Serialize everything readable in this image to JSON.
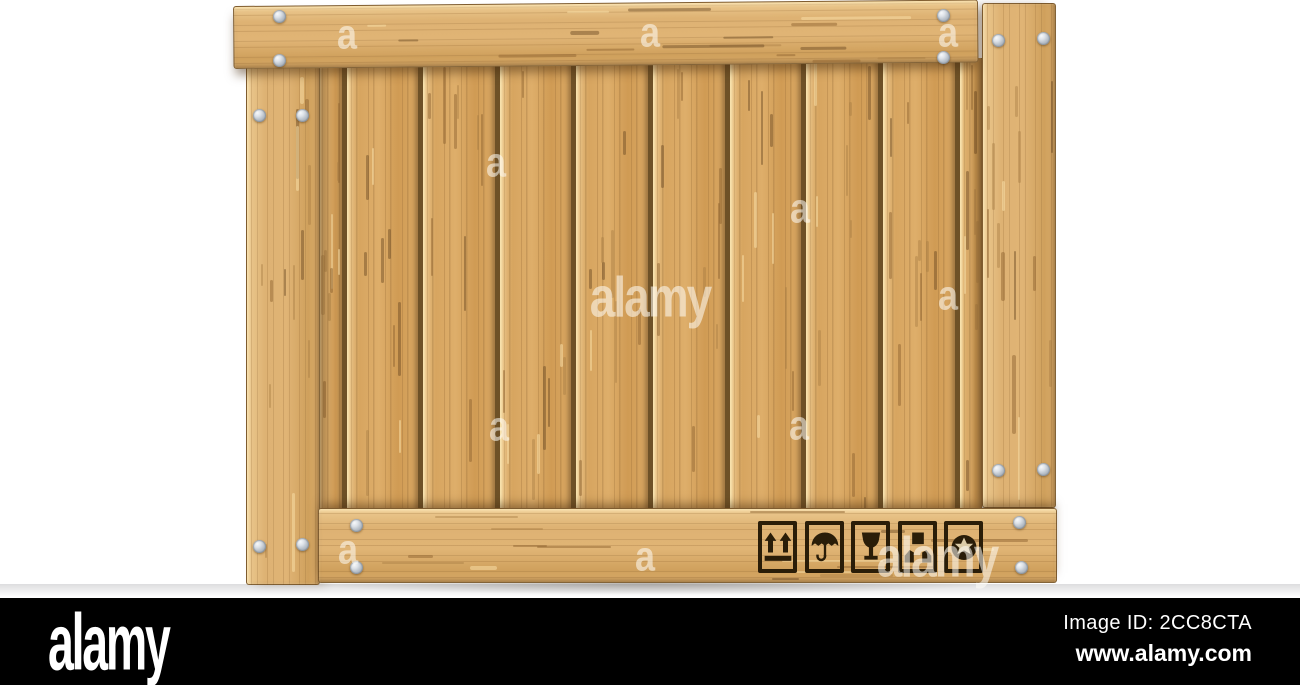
{
  "footer": {
    "logo": "alamy",
    "image_id": "Image ID: 2CC8CTA",
    "url": "www.alamy.com"
  },
  "watermark": {
    "small_label": "a",
    "large_label": "alamy"
  },
  "crate": {
    "symbols": [
      {
        "name": "this-side-up"
      },
      {
        "name": "keep-dry"
      },
      {
        "name": "fragile"
      },
      {
        "name": "handle-with-care"
      },
      {
        "name": "recycle"
      }
    ]
  },
  "colors": {
    "background": "#ffffff",
    "wood_light": "#ecca90",
    "wood_mid": "#d7a560",
    "wood_gap_dark": "#6e5127",
    "frame_outline": "#5f431f",
    "rivet_gray": "#b9c1ca",
    "symbol_ink": "#2a1d08",
    "footer_bar": "#000000",
    "watermark_white": "rgba(255,253,247,0.55)"
  }
}
